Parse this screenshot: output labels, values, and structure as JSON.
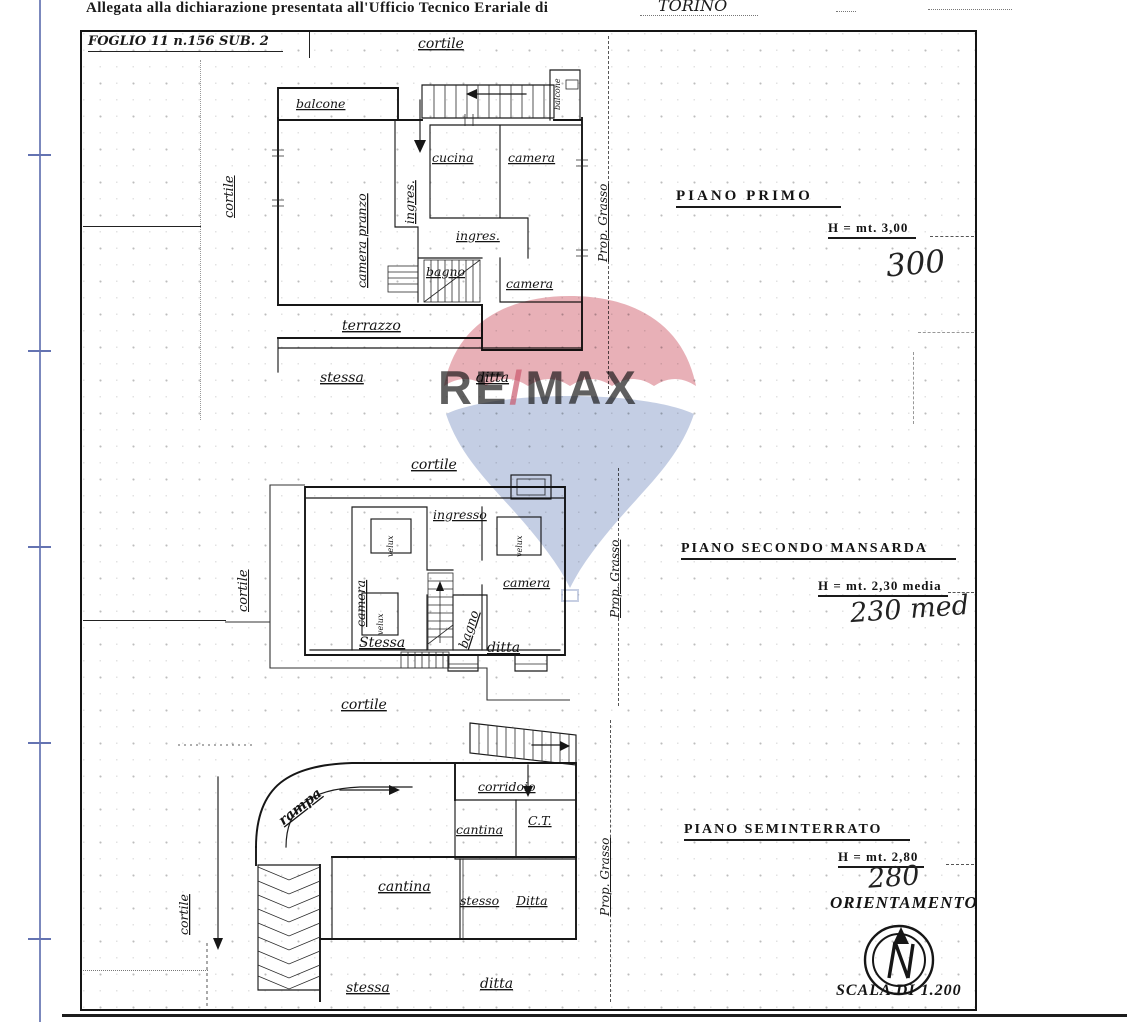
{
  "header": {
    "line": "Allegata alla dichiarazione presentata all'Ufficio Tecnico Erariale di",
    "city": "TORINO"
  },
  "sheet": {
    "foglio": "FOGLIO 11 n.156 SUB. 2"
  },
  "plan1": {
    "title": "PIANO PRIMO",
    "height": "H = mt. 3,00",
    "hand": "300",
    "owner": "Prop. Grasso",
    "labels": {
      "cortile_top": "cortile",
      "cortile_left": "cortile",
      "balcone": "balcone",
      "balcone_right": "balcone",
      "cucina": "cucina",
      "camera1": "camera",
      "ingres_corr": "ingres.",
      "camera_pranzo": "camera pranzo",
      "ingres_hall": "ingres.",
      "bagno": "bagno",
      "camera2": "camera",
      "terrazzo": "terrazzo",
      "stessa": "stessa",
      "ditta": "ditta"
    }
  },
  "plan2": {
    "title": "PIANO SECONDO MANSARDA",
    "height": "H = mt. 2,30 media",
    "hand": "230 med",
    "owner": "Prop. Grasso",
    "labels": {
      "cortile_top": "cortile",
      "cortile_left": "cortile",
      "ingresso": "ingresso",
      "camera_left": "camera",
      "velux1": "velux",
      "velux2": "velux",
      "velux3": "velux",
      "camera_right": "camera",
      "bagno": "bagno",
      "stessa": "Stessa",
      "ditta": "ditta",
      "cortile_bottom": "cortile"
    }
  },
  "plan3": {
    "title": "PIANO SEMINTERRATO",
    "height": "H = mt. 2,80",
    "hand": "280",
    "owner": "Prop. Grasso",
    "labels": {
      "cortile_left": "cortile",
      "rampa": "rampa",
      "corridoio": "corridoio",
      "cantina_small": "cantina",
      "ct": "C.T.",
      "cantina_large": "cantina",
      "stesso": "stesso",
      "ditta_small": "Ditta",
      "stessa": "stessa",
      "ditta": "ditta"
    }
  },
  "orientation": {
    "title": "ORIENTAMENTO",
    "scale": "SCALA DI 1.200",
    "north": "N"
  },
  "watermark": {
    "re": "RE",
    "slash": "/",
    "max": "MAX"
  },
  "colors": {
    "ink": "#1a1a1a",
    "ruler_blue": "#6473b2",
    "wm_red": "#cf5a68",
    "wm_blue": "#93a5cd",
    "wm_text_blue": "#3a4da8"
  }
}
